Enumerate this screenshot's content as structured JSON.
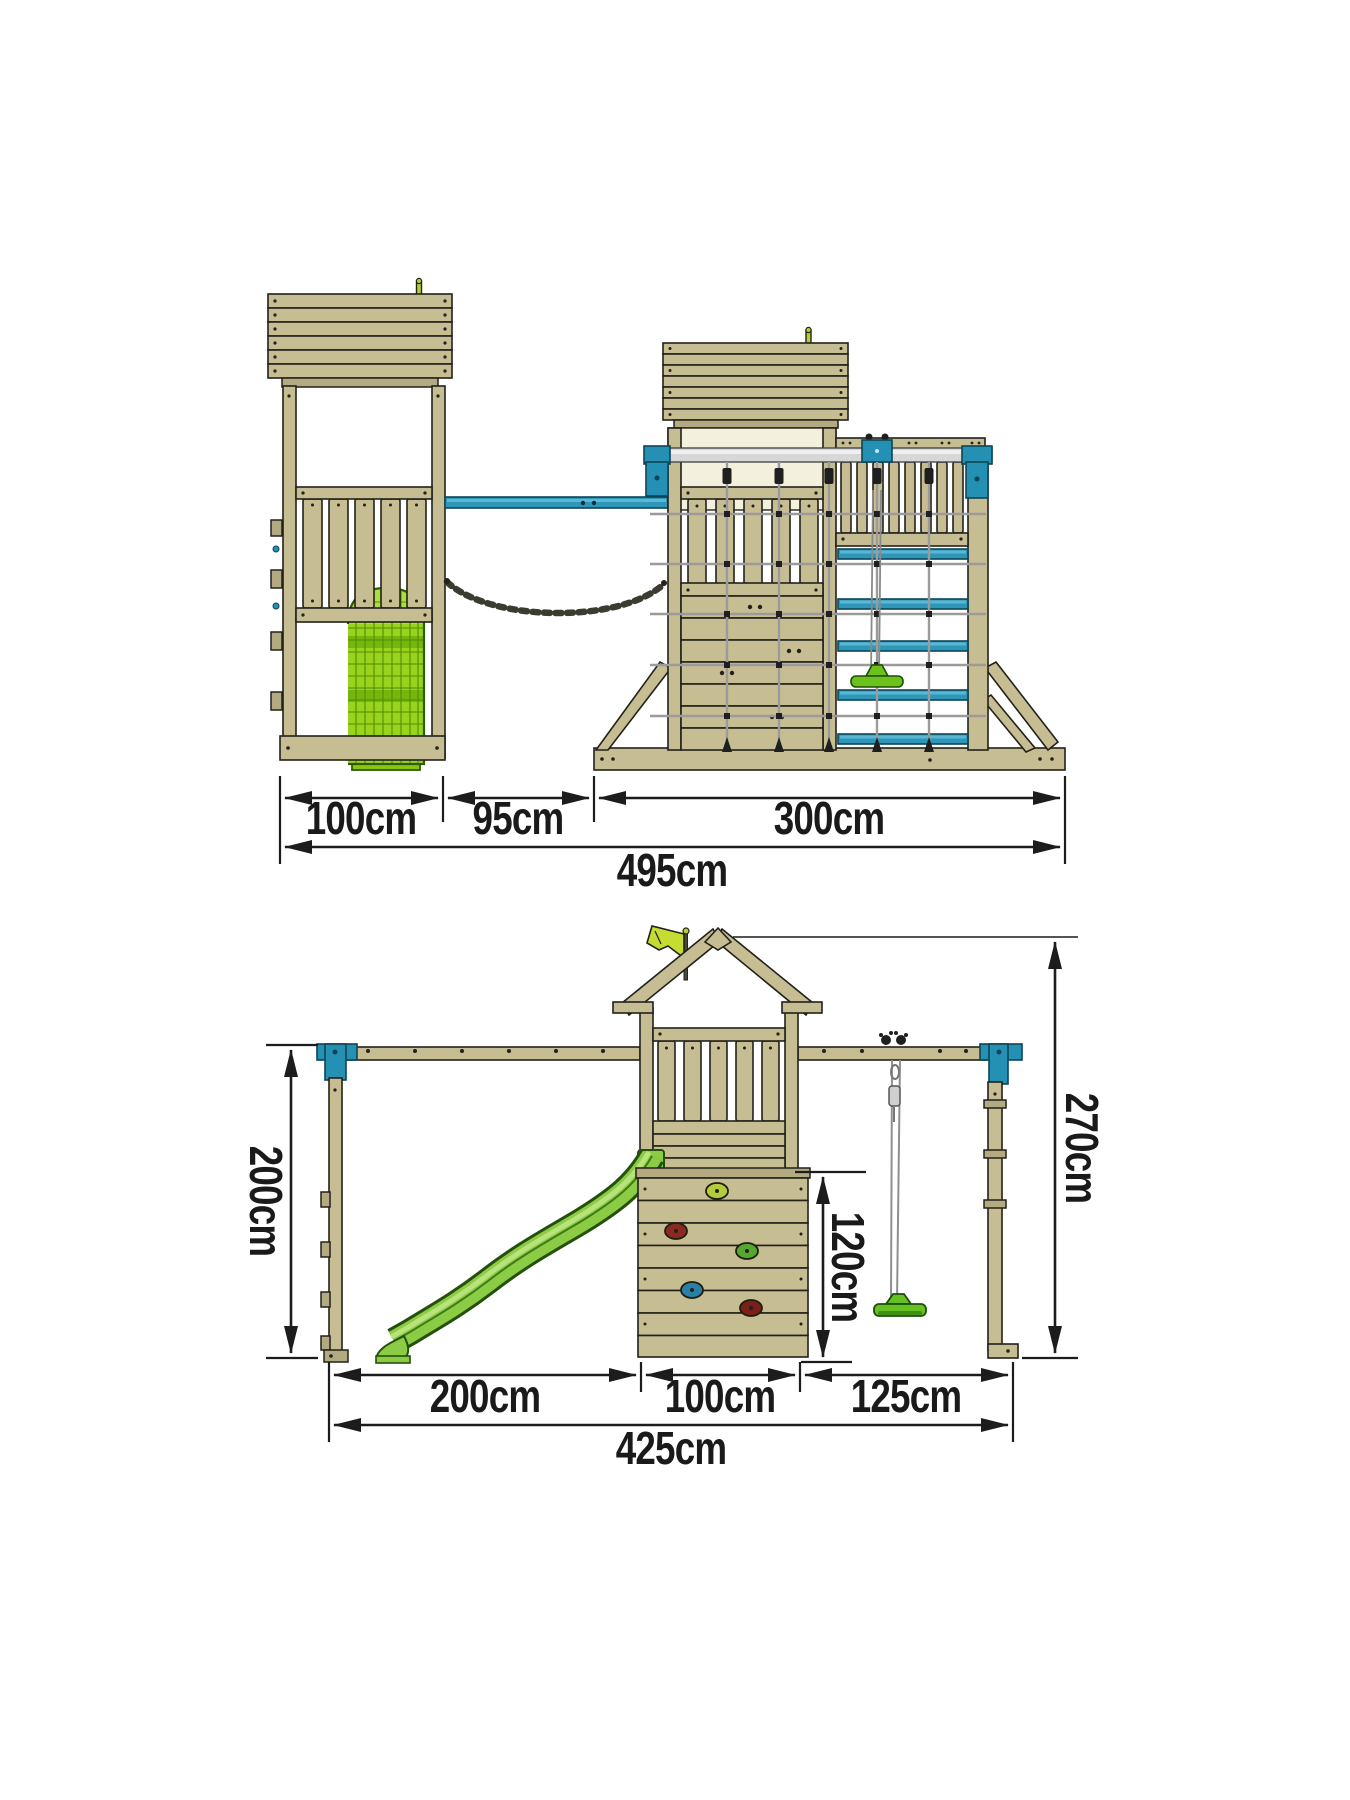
{
  "colors": {
    "wood": "#c6bd92",
    "wood_shade": "#b3aa82",
    "outline_ink": "#22211a",
    "accent_blue": "#2390b4",
    "slide_green": "#8ccc44",
    "tube_green": "#99d31d",
    "seat_green": "#66c222",
    "flag_green": "#c7dc33",
    "silver_beam": "#d7d7d7",
    "cream_panel": "#f3f0dd",
    "dimension_ink": "#1c1c1c"
  },
  "side_view": {
    "width_tower": "100cm",
    "width_gap": "95cm",
    "width_climbing_frame": "300cm",
    "width_total": "495cm"
  },
  "front_view": {
    "width_slide": "200cm",
    "width_tower": "100cm",
    "width_swing": "125cm",
    "width_total": "425cm",
    "height_frame": "200cm",
    "height_climbing_wall": "120cm",
    "height_total": "270cm"
  }
}
